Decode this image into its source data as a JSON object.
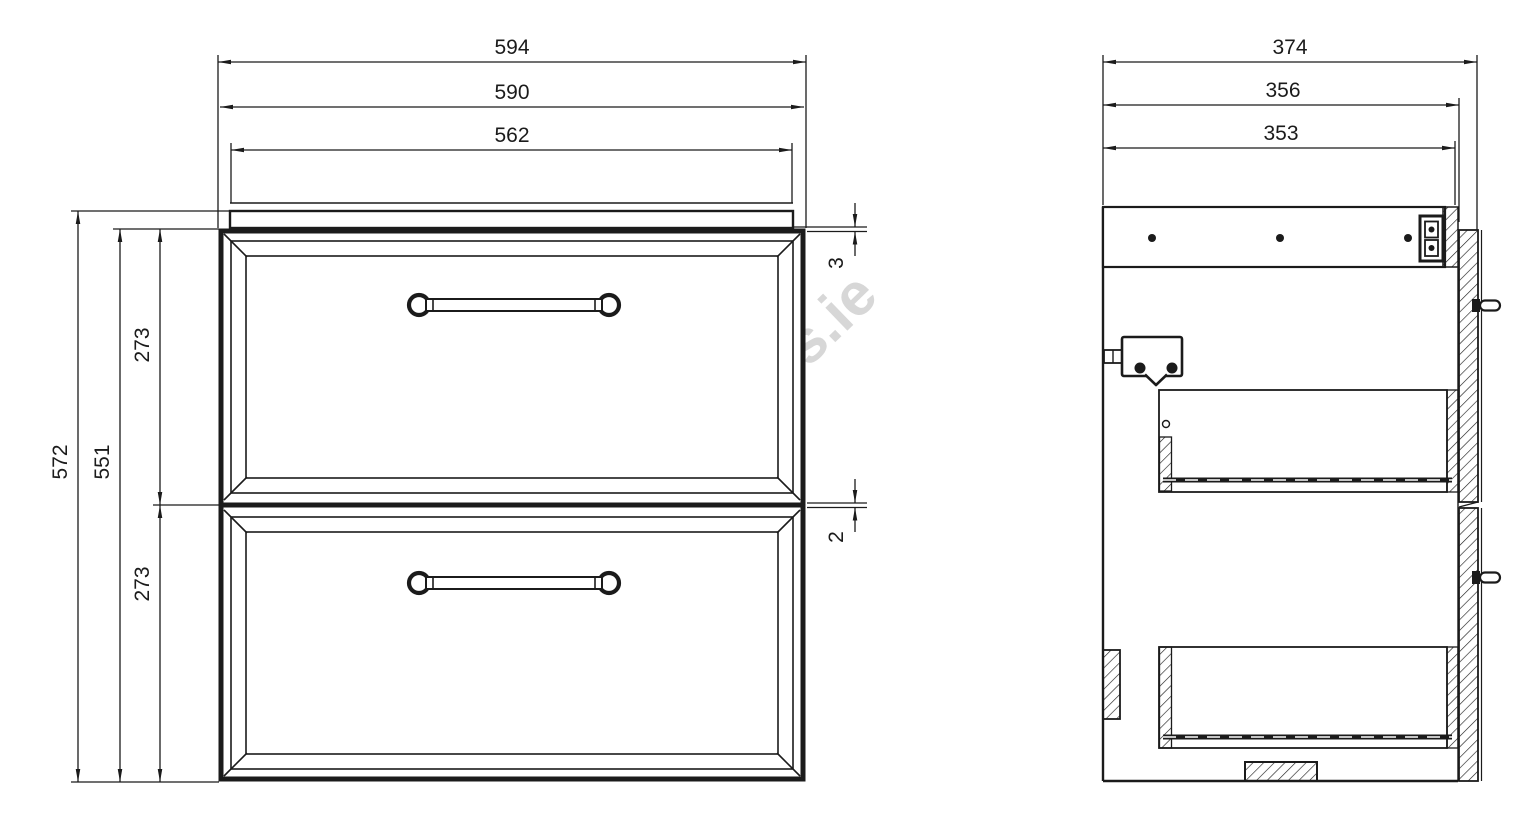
{
  "watermark": {
    "text": "alasans.ie",
    "color": "#d5d5d5"
  },
  "front_view": {
    "dimensions": {
      "overall_width": "594",
      "carcass_width": "590",
      "countertop_width": "562",
      "overall_height": "572",
      "carcass_height": "551",
      "top_drawer_height": "273",
      "bottom_drawer_height": "273",
      "countertop_lip": "3",
      "drawer_gap": "2"
    }
  },
  "side_view": {
    "dimensions": {
      "overall_depth": "374",
      "carcass_depth": "356",
      "internal_depth": "353"
    }
  },
  "line_color": "#1b1b1b"
}
